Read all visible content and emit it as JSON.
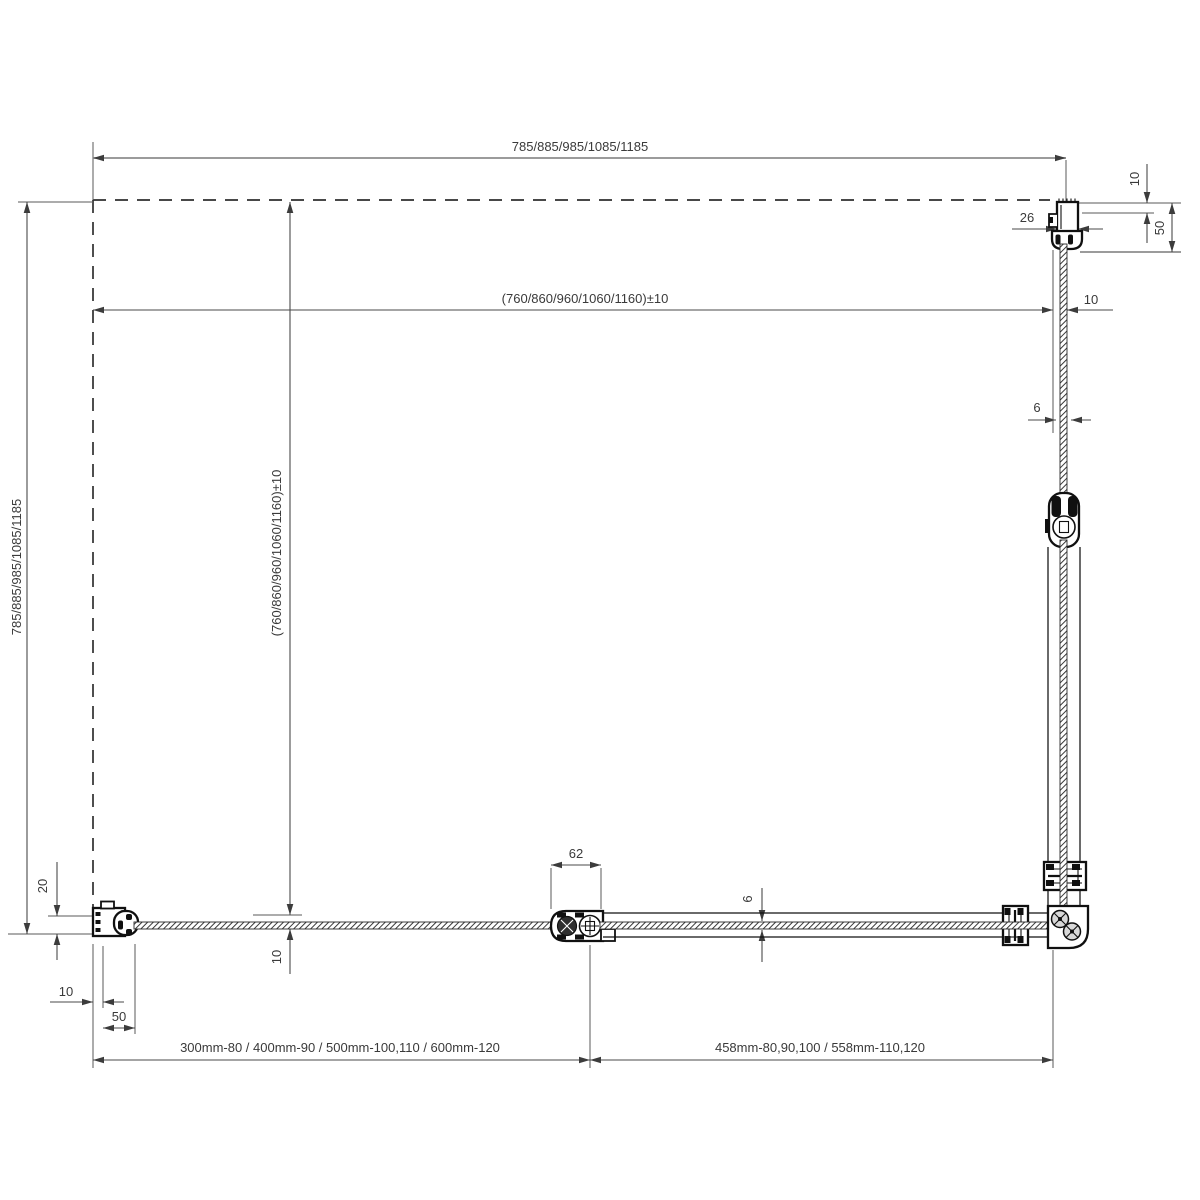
{
  "drawing": {
    "title": "Corner-entry shower enclosure - plan view technical drawing",
    "background": "#ffffff",
    "line_color": "#101010",
    "dimension_color": "#4a4a4a",
    "glass_hatch_color": "#2e2e2e"
  },
  "dims": {
    "overall_width": "785/885/985/1085/1185",
    "inner_width": "(760/860/960/1060/1160)±10",
    "overall_height": "785/885/985/1085/1185",
    "inner_height": "(760/860/960/1060/1160)±10",
    "offset_right": "10",
    "offset_bottom": "10",
    "wall_profile_top_width": "26",
    "wall_profile_top_clearance": "10",
    "wall_profile_top_depth": "50",
    "glass_thickness_side": "6",
    "glass_thickness_door": "6",
    "hinge_width": "62",
    "wall_profile_left_depth": "20",
    "wall_profile_left_clearance": "10",
    "wall_profile_left_adjust": "50",
    "fixed_panel_sizes": "300mm-80 / 400mm-90 / 500mm-100,110 / 600mm-120",
    "door_sizes": "458mm-80,90,100 / 558mm-110,120"
  }
}
